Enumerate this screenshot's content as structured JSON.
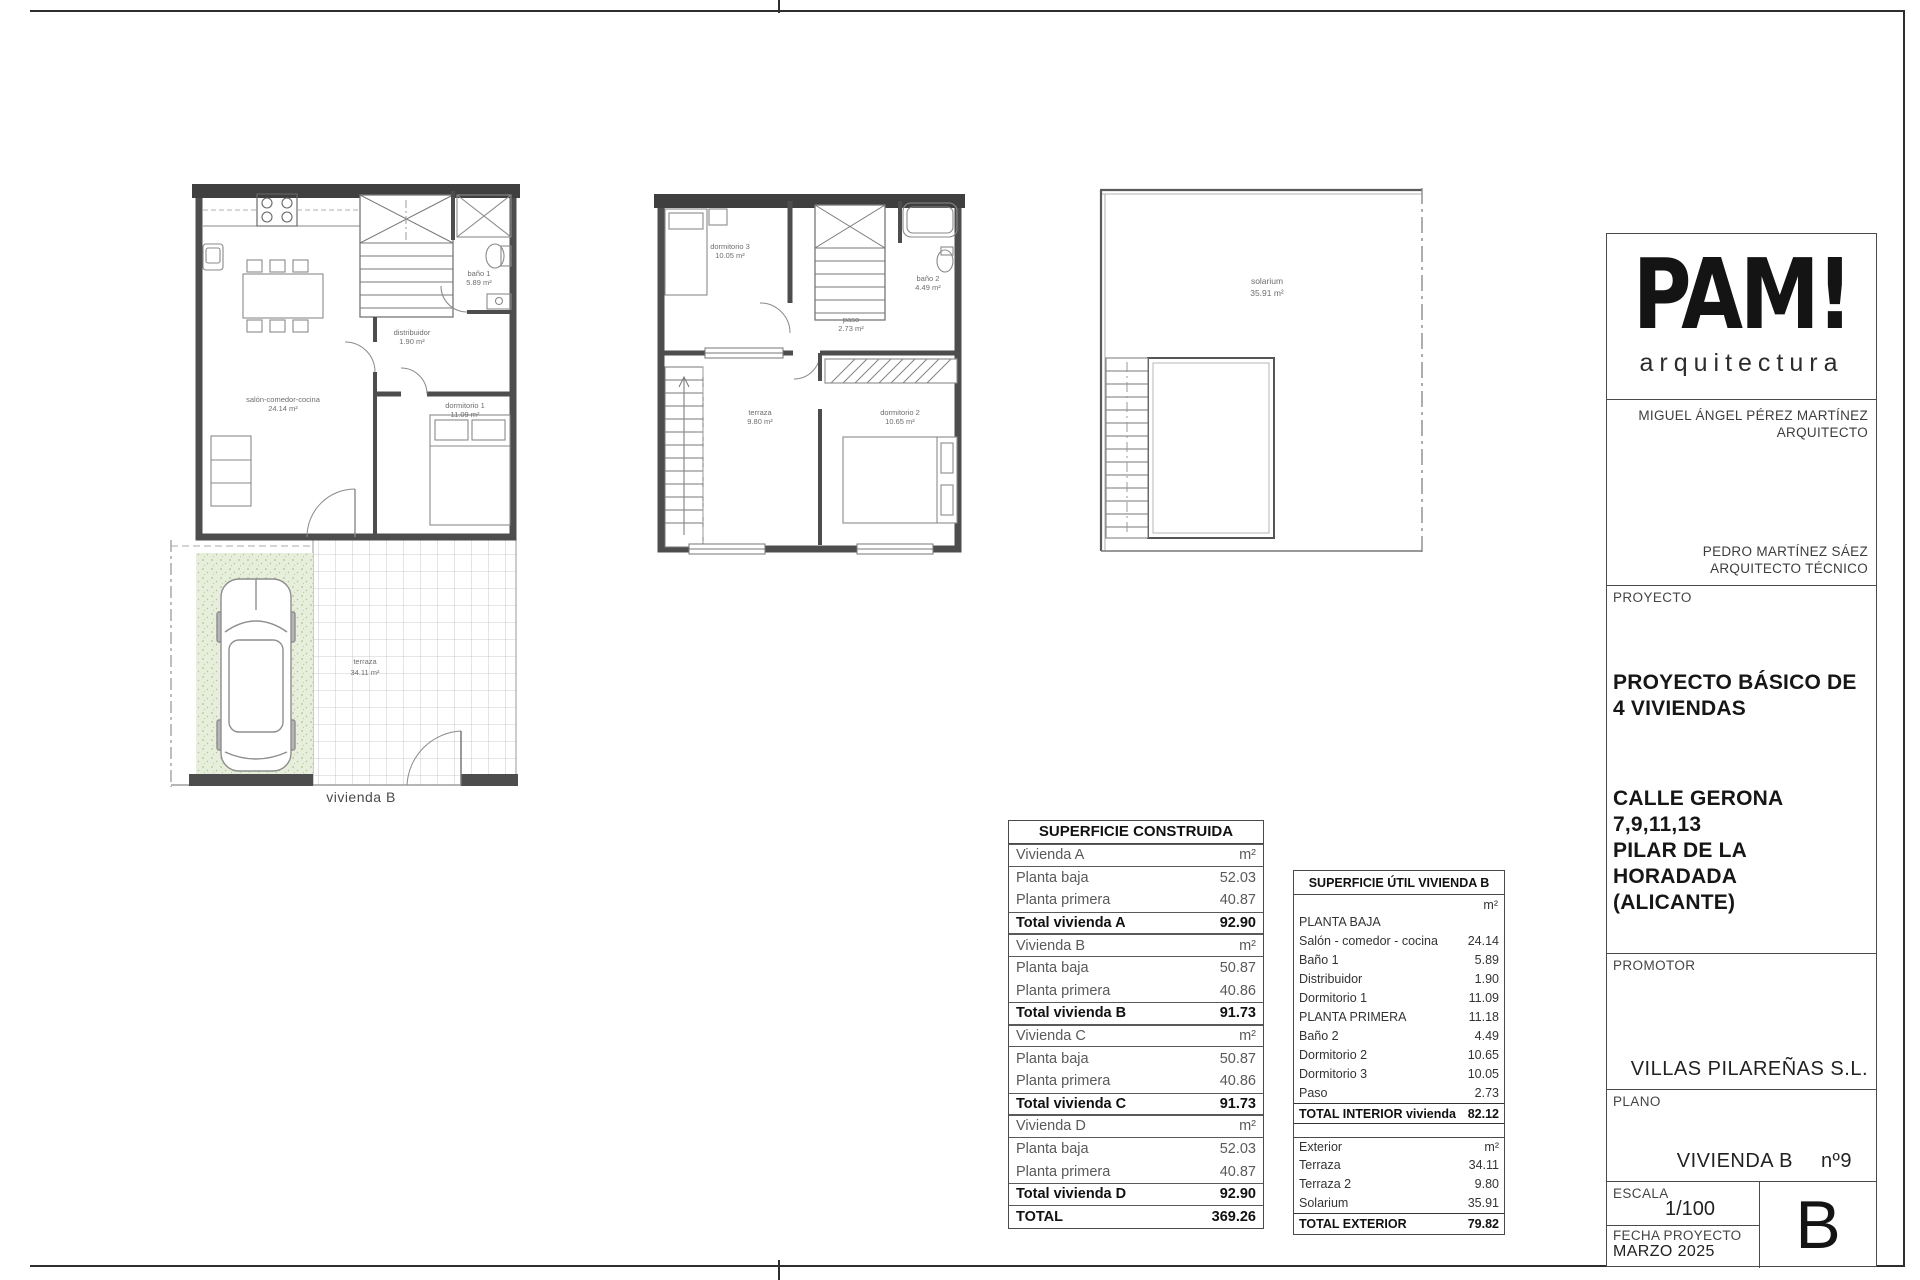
{
  "plans": {
    "ground": {
      "caption": "vivienda B",
      "rooms": {
        "salon": {
          "name": "salón-comedor-cocina",
          "area": "24.14 m²"
        },
        "distribuidor": {
          "name": "distribuidor",
          "area": "1.90 m²"
        },
        "bano1": {
          "name": "baño 1",
          "area": "5.89 m²"
        },
        "dormitorio1": {
          "name": "dormitorio 1",
          "area": "11.09 m²"
        },
        "terraza": {
          "name": "terraza",
          "area": "34.11 m²"
        }
      }
    },
    "first": {
      "rooms": {
        "dormitorio3": {
          "name": "dormitorio 3",
          "area": "10.05 m²"
        },
        "bano2": {
          "name": "baño 2",
          "area": "4.49 m²"
        },
        "paso": {
          "name": "paso",
          "area": "2.73 m²"
        },
        "terraza": {
          "name": "terraza",
          "area": "9.80 m²"
        },
        "dormitorio2": {
          "name": "dormitorio 2",
          "area": "10.65 m²"
        }
      }
    },
    "solarium": {
      "rooms": {
        "solarium": {
          "name": "solarium",
          "area": "35.91 m²"
        }
      }
    }
  },
  "construida": {
    "title": "SUPERFICIE CONSTRUIDA",
    "rows": [
      {
        "label": "Vivienda A",
        "value": "m²"
      },
      {
        "label": "Planta baja",
        "value": "52.03"
      },
      {
        "label": "Planta primera",
        "value": "40.87"
      },
      {
        "label": "Total vivienda A",
        "value": "92.90"
      },
      {
        "label": "Vivienda B",
        "value": "m²"
      },
      {
        "label": "Planta baja",
        "value": "50.87"
      },
      {
        "label": "Planta primera",
        "value": "40.86"
      },
      {
        "label": "Total vivienda B",
        "value": "91.73"
      },
      {
        "label": "Vivienda C",
        "value": "m²"
      },
      {
        "label": "Planta baja",
        "value": "50.87"
      },
      {
        "label": "Planta primera",
        "value": "40.86"
      },
      {
        "label": "Total vivienda C",
        "value": "91.73"
      },
      {
        "label": "Vivienda D",
        "value": "m²"
      },
      {
        "label": "Planta baja",
        "value": "52.03"
      },
      {
        "label": "Planta primera",
        "value": "40.87"
      },
      {
        "label": "Total vivienda D",
        "value": "92.90"
      },
      {
        "label": "TOTAL",
        "value": "369.26"
      }
    ]
  },
  "util": {
    "title": "SUPERFICIE ÚTIL VIVIENDA B",
    "unit": "m²",
    "interior_rows": [
      {
        "label": "PLANTA BAJA",
        "value": ""
      },
      {
        "label": "Salón - comedor - cocina",
        "value": "24.14"
      },
      {
        "label": "Baño 1",
        "value": "5.89"
      },
      {
        "label": "Distribuidor",
        "value": "1.90"
      },
      {
        "label": "Dormitorio 1",
        "value": "11.09"
      },
      {
        "label": "PLANTA PRIMERA",
        "value": "11.18"
      },
      {
        "label": "Baño 2",
        "value": "4.49"
      },
      {
        "label": "Dormitorio 2",
        "value": "10.65"
      },
      {
        "label": "Dormitorio 3",
        "value": "10.05"
      },
      {
        "label": "Paso",
        "value": "2.73"
      }
    ],
    "interior_total": {
      "label": "TOTAL INTERIOR vivienda",
      "value": "82.12"
    },
    "exterior_header": {
      "label": "Exterior",
      "value": "m²"
    },
    "exterior_rows": [
      {
        "label": "Terraza",
        "value": "34.11"
      },
      {
        "label": "Terraza 2",
        "value": "9.80"
      },
      {
        "label": "Solarium",
        "value": "35.91"
      }
    ],
    "exterior_total": {
      "label": "TOTAL EXTERIOR",
      "value": "79.82"
    }
  },
  "titleblock": {
    "logo_main": "PAM!",
    "logo_sub": "arquitectura",
    "architect_name": "MIGUEL ÁNGEL PÉREZ MARTÍNEZ",
    "architect_role": "ARQUITECTO",
    "tech_name": "PEDRO MARTÍNEZ SÁEZ",
    "tech_role": "ARQUITECTO TÉCNICO",
    "proyecto_label": "PROYECTO",
    "proyecto_line1": "PROYECTO BÁSICO DE",
    "proyecto_line2": "4 VIVIENDAS",
    "address_line1": "CALLE GERONA",
    "address_line2": "7,9,11,13",
    "address_line3": "PILAR DE LA HORADADA",
    "address_line4": "(ALICANTE)",
    "promotor_label": "PROMOTOR",
    "promotor_name": "VILLAS PILAREÑAS S.L.",
    "plano_label": "PLANO",
    "plano_name": "VIVIENDA B",
    "plano_num": "nº9",
    "escala_label": "ESCALA",
    "escala_value": "1/100",
    "fecha_label": "FECHA PROYECTO",
    "fecha_value": "MARZO 2025",
    "sheet_letter": "B"
  }
}
